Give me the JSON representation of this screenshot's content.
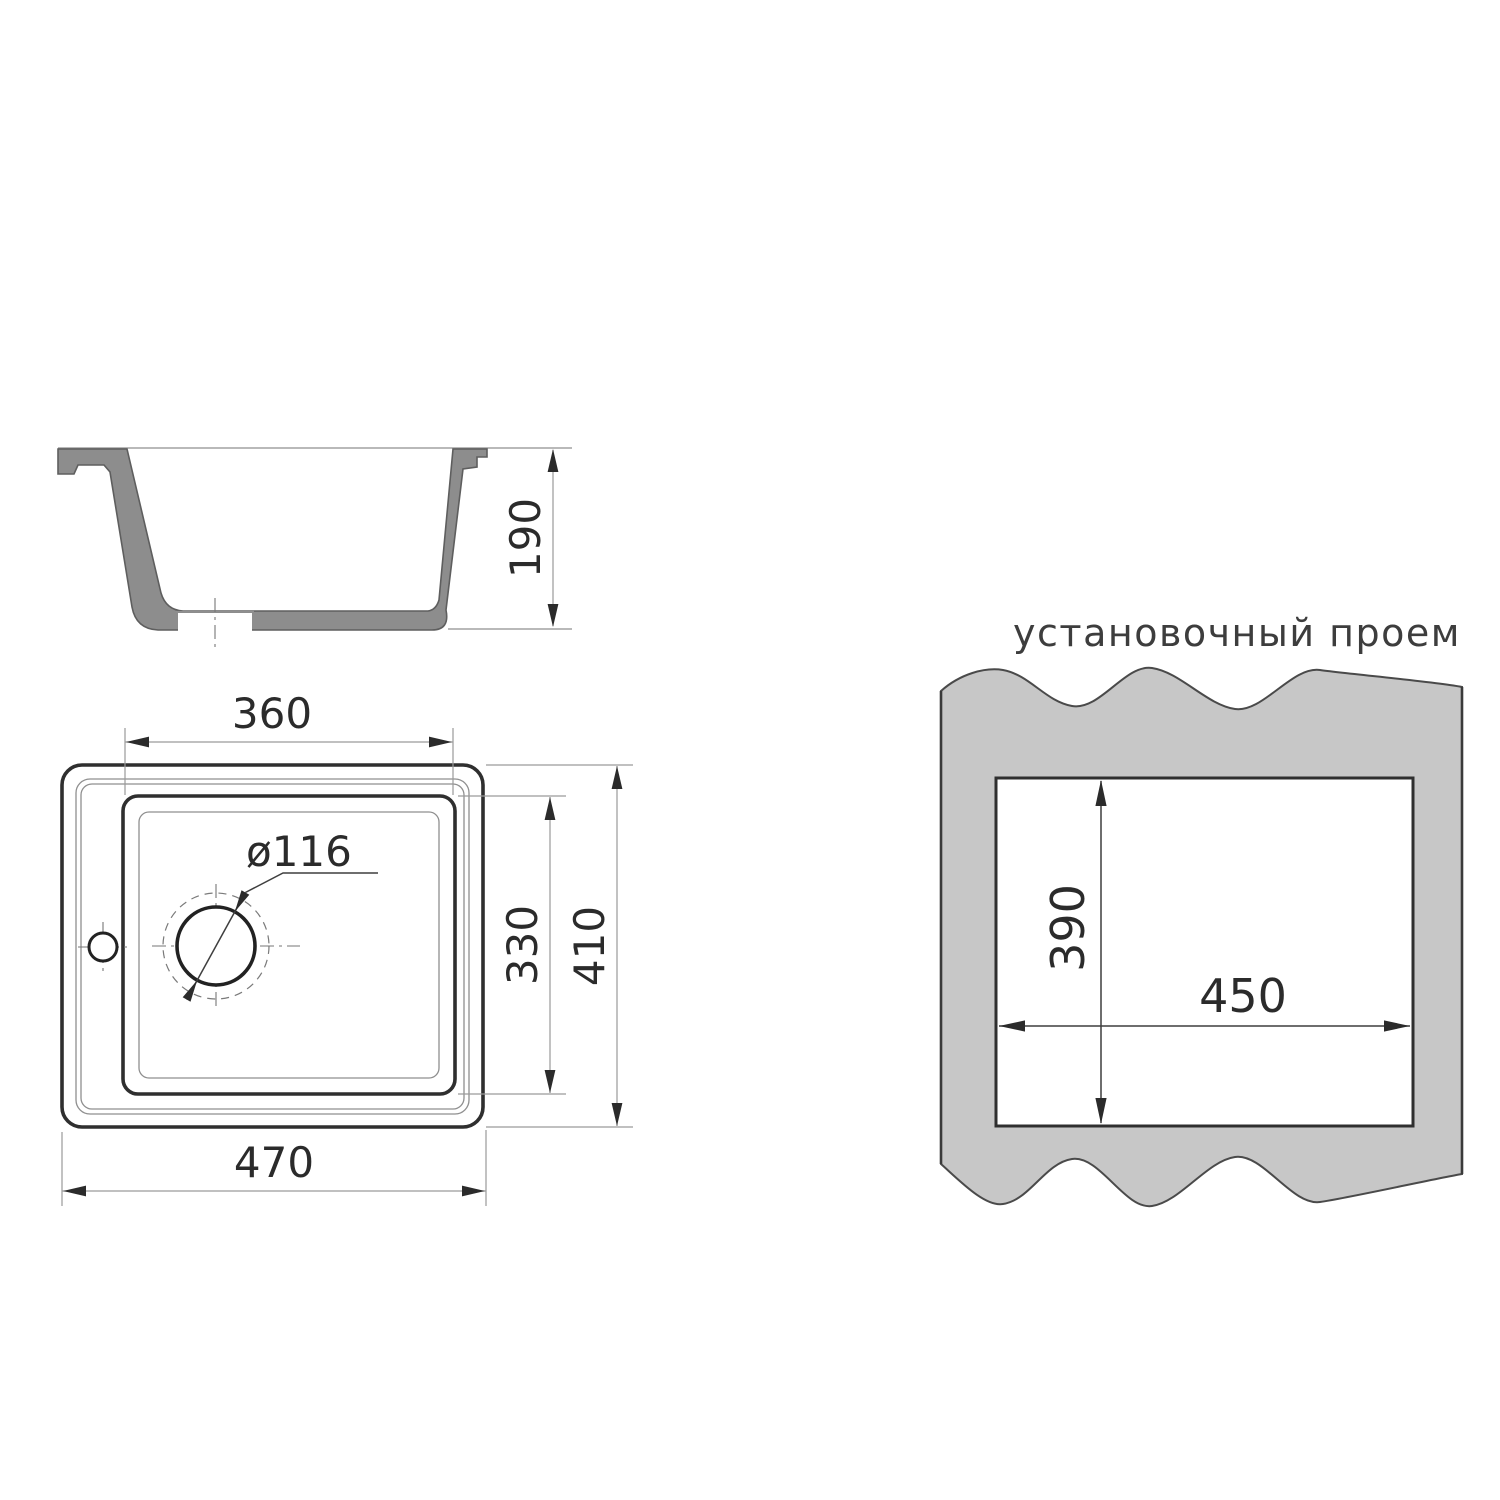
{
  "colors": {
    "background": "#ffffff",
    "line": "#2f2f2f",
    "thin_line": "#8f8f8f",
    "section_fill": "#8d8d8d",
    "panel_fill": "#c7c7c7",
    "text": "#2b2b2b"
  },
  "section_view": {
    "height_label": "190"
  },
  "top_view": {
    "bowl_width_label": "360",
    "bowl_depth_label": "330",
    "overall_height_label": "410",
    "overall_width_label": "470",
    "drain_diameter_label": "ø116"
  },
  "installation_view": {
    "title": "установочный проем",
    "opening_height_label": "390",
    "opening_width_label": "450"
  }
}
